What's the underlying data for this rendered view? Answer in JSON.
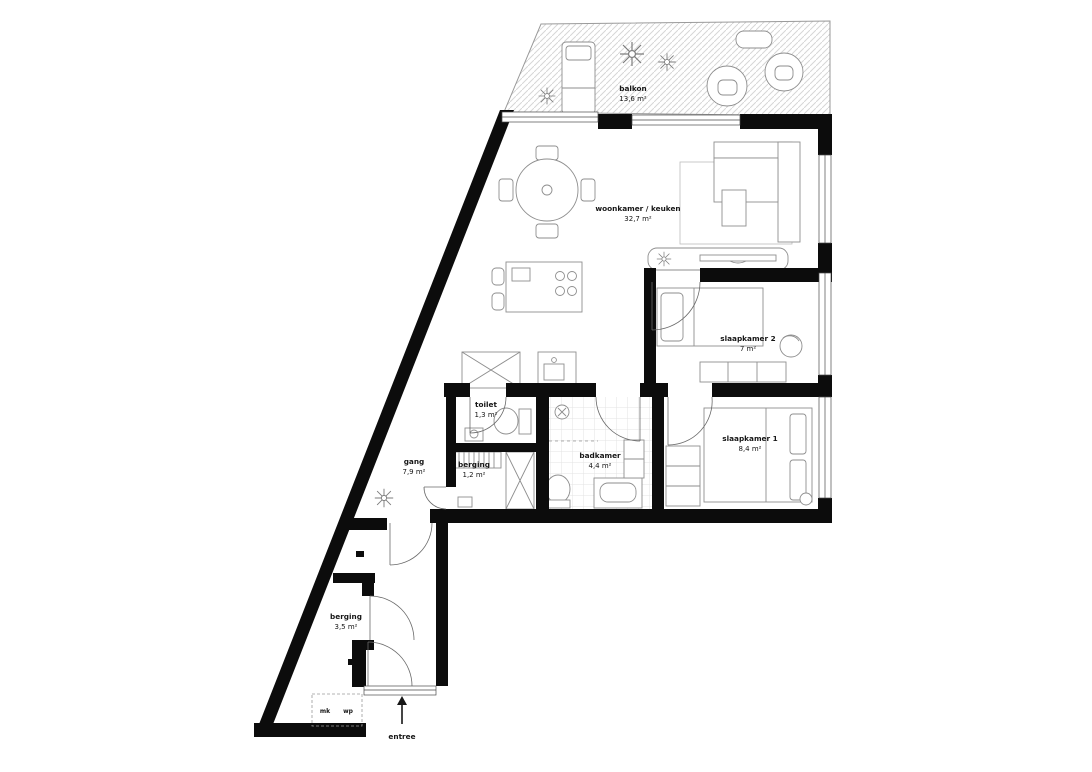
{
  "plan": {
    "type": "apartment floor plan",
    "colors": {
      "wall": "#0c0c0c",
      "furniture_line": "#8e8e8e",
      "hatch_line": "#d6d6d6",
      "tile_line": "#e3e3e3",
      "label_text": "#161616",
      "background": "#ffffff"
    },
    "rooms": {
      "balkon": {
        "name": "balkon",
        "area": "13,6 m²"
      },
      "woonkamer": {
        "name": "woonkamer / keuken",
        "area": "32,7 m²"
      },
      "slaapkamer2": {
        "name": "slaapkamer 2",
        "area": "7 m²"
      },
      "slaapkamer1": {
        "name": "slaapkamer 1",
        "area": "8,4 m²"
      },
      "badkamer": {
        "name": "badkamer",
        "area": "4,4 m²"
      },
      "toilet": {
        "name": "toilet",
        "area": "1,3 m²"
      },
      "gang": {
        "name": "gang",
        "area": "7,9 m²"
      },
      "berging_klein": {
        "name": "berging",
        "area": "1,2 m²"
      },
      "berging_groot": {
        "name": "berging",
        "area": "3,5 m²"
      }
    },
    "labels": {
      "entree": "entree",
      "mk": "mk",
      "wp": "wp"
    }
  }
}
